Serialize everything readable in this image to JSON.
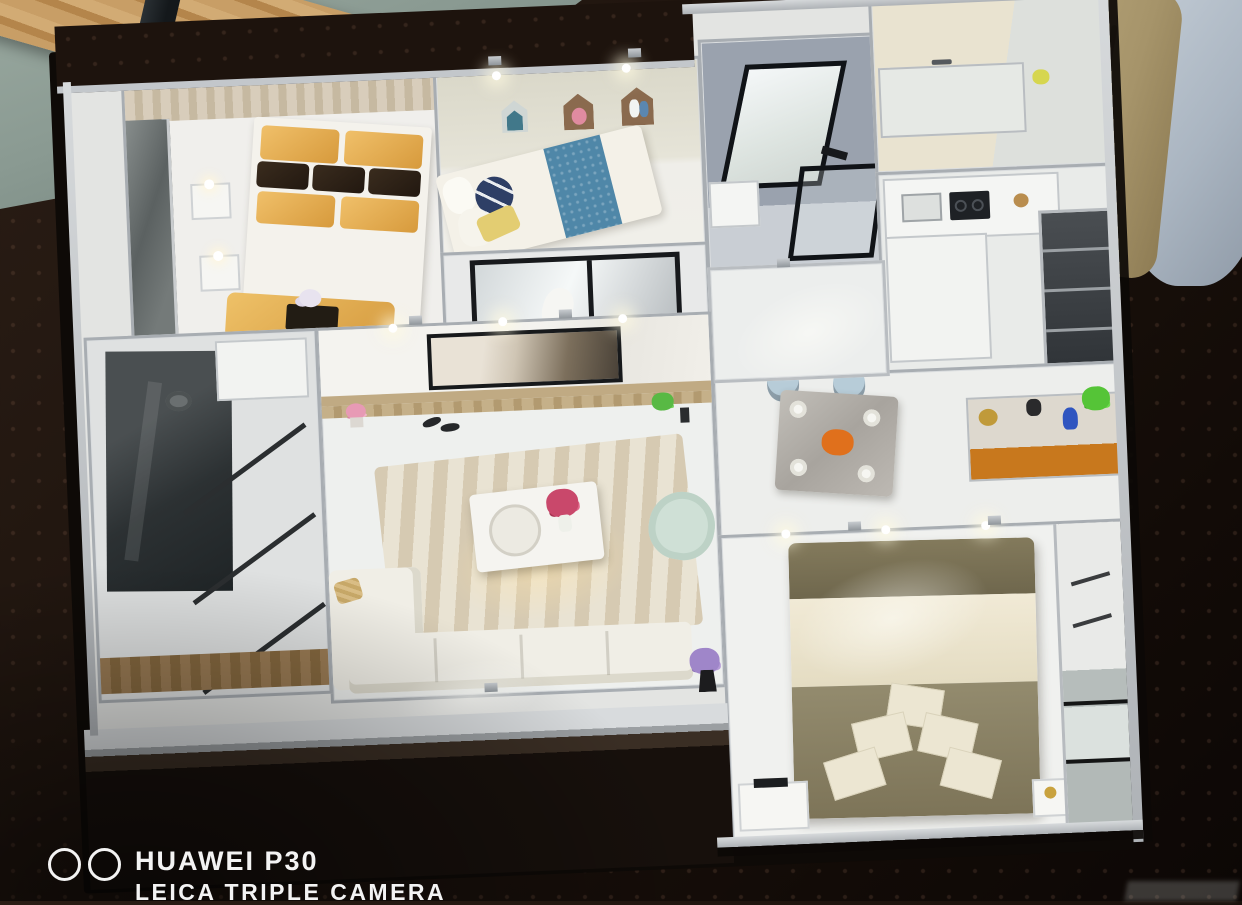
{
  "image": {
    "kind": "photograph",
    "subject": "Miniature dollhouse-style apartment sales model viewed from above on a dark patterned carpet",
    "notes": "Overhead oblique view; model rooms fully furnished and internally lit; a person stands at top right; wood plank and table leg on green-gray floor at top left"
  },
  "watermark": {
    "icon": "dual-lens-circles-icon",
    "device": "HUAWEI P30",
    "tagline": "LEICA TRIPLE CAMERA",
    "color": "#f3f3f3",
    "position": "bottom-left, tagline partially cropped by image edge"
  },
  "corner_mark": {
    "note": "very faint cropped overlay text at bottom-right edge, unreadable"
  },
  "scene": {
    "background": {
      "surface": "dark brown carpet with dot texture",
      "floor_top_left": "green-gray concrete floor with wooden plank and dark table leg",
      "person_top_right": "standing person: khaki trousers, gray-blue top"
    },
    "model": {
      "frame_color": "#b9bdc1",
      "floor_color": "#eef0ee",
      "rooms": [
        {
          "name": "gold-bedroom",
          "items": [
            "double bed with gold satin pillows",
            "dark brown accent pillows",
            "gold bench with black tray and flowers",
            "two white nightstands with lamps",
            "mirrored wardrobe",
            "wood feature wall"
          ],
          "colors": [
            "#dda84e",
            "#3a2c1e"
          ]
        },
        {
          "name": "kids-bedroom",
          "items": [
            "bed with blue patterned runner",
            "yellow pillow",
            "navy striped round pillow",
            "three house-shaped wall shelves",
            "ceiling spotlights"
          ],
          "colors": [
            "#4f87a8",
            "#e3cd72",
            "#41788a",
            "#8a6a4e"
          ]
        },
        {
          "name": "study",
          "items": [
            "black-framed glass partition",
            "white desk chair"
          ],
          "colors": [
            "#17191c"
          ]
        },
        {
          "name": "upper-bathroom",
          "items": [
            "black-framed wall mirror",
            "white washbasin",
            "black-framed shower screen"
          ],
          "colors": [
            "#9aa2ae"
          ]
        },
        {
          "name": "vanity-laundry",
          "items": [
            "marble counter with faucet",
            "yellow accessory"
          ],
          "colors": [
            "#e9e3d0"
          ]
        },
        {
          "name": "kitchen",
          "items": [
            "L-shaped white counter",
            "black cooktop",
            "sink",
            "tall dark glass-front cabinets"
          ],
          "colors": [
            "#3c4044"
          ]
        },
        {
          "name": "dining-area",
          "items": [
            "gray marble dining table",
            "four cup-and-saucer settings",
            "orange floral centerpiece",
            "two light-blue upholstered chairs",
            "sideboard with orange front",
            "blue vase",
            "green plant",
            "gold charger plate",
            "dark kettle"
          ],
          "colors": [
            "#b7ccd8",
            "#c8781d",
            "#2f55c0"
          ]
        },
        {
          "name": "hallway",
          "items": [
            "glossy tile floor"
          ],
          "colors": [
            "#eceeed"
          ]
        },
        {
          "name": "living-room",
          "items": [
            "wall-mounted TV on marble feature wall",
            "wood media ledge",
            "pink potted flowers",
            "slippers",
            "green plant",
            "beige wave-patterned rug",
            "white coffee table with round tray",
            "pink flower arrangement",
            "white L-shaped sofa with chaise",
            "tan striped pillow",
            "mint-green armchair",
            "purple flowers in black vase"
          ],
          "colors": [
            "#cfe0d6",
            "#9f86c9",
            "#d6cab2"
          ]
        },
        {
          "name": "left-bathroom",
          "items": [
            "dark glass shower enclosure",
            "white vanity",
            "black-framed glass partition bars",
            "wood-look floor strip"
          ],
          "colors": [
            "#2c3133",
            "#9a7b54"
          ]
        },
        {
          "name": "master-bedroom",
          "items": [
            "king bed with olive duvet",
            "cream runner band",
            "five stacked cream pillows",
            "white dresser with small TV",
            "nightstand with gold lamp",
            "wardrobe with mirrored doors",
            "ceiling spotlights"
          ],
          "colors": [
            "#8c8468",
            "#ece5cf"
          ]
        }
      ]
    }
  },
  "palette": {
    "carpet": "#1d130d",
    "concrete_floor": "#8fa099",
    "wood_plank": "#c89e66",
    "person_pants": "#b0a074",
    "person_shirt": "#b9c3cd",
    "model_frame": "#b9bdc1",
    "model_floor": "#eef0ee",
    "gold": "#dda84e",
    "kids_blue": "#4f87a8",
    "teal_house": "#41788a",
    "mint_armchair": "#cfe0d6",
    "orange_sideboard": "#c8781d",
    "olive_duvet": "#8c8468",
    "cream": "#ece5cf",
    "dining_chair_blue": "#b7ccd8",
    "purple_flowers": "#9f86c9",
    "plant_green": "#55c437",
    "pink_flowers": "#e79ab5"
  }
}
